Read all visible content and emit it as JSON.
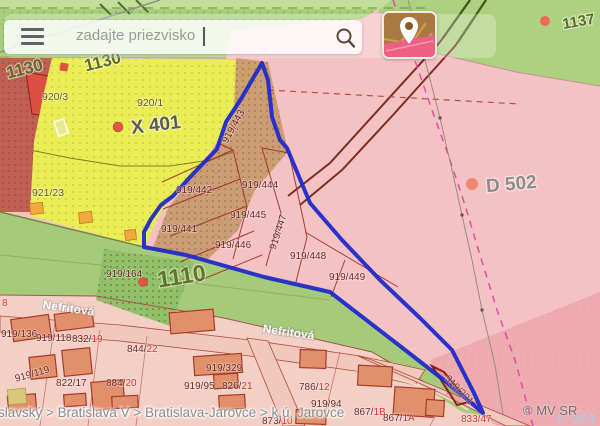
{
  "search": {
    "placeholder": "zadajte priezvisko"
  },
  "breadcrumb": {
    "text": "islavský > Bratislava V > Bratislava-Jarovce > k.ú. Jarovce"
  },
  "attribution": {
    "mvsr": "© MV SR",
    "partial": "© 201"
  },
  "zone_labels": [
    {
      "text": "1130"
    },
    {
      "text": "1130"
    },
    {
      "text": "1137"
    },
    {
      "text": "X 401"
    },
    {
      "text": "D 502"
    },
    {
      "text": "1110"
    },
    {
      "text": "920/1"
    },
    {
      "text": "920/3"
    },
    {
      "text": "921/23"
    }
  ],
  "parcel_labels": [
    {
      "text": "919/443"
    },
    {
      "text": "919/442"
    },
    {
      "text": "919/444"
    },
    {
      "text": "919/445"
    },
    {
      "text": "919/441"
    },
    {
      "text": "919/446"
    },
    {
      "text": "919/447"
    },
    {
      "text": "919/448"
    },
    {
      "text": "919/449"
    },
    {
      "text": "919/164"
    },
    {
      "text": "919/201"
    }
  ],
  "address_labels": [
    {
      "text": "",
      "red": "8"
    },
    {
      "text": "919/136",
      "red": ""
    },
    {
      "text": "919/118",
      "red": ""
    },
    {
      "text": "832/",
      "red": "19"
    },
    {
      "text": "844/",
      "red": "22"
    },
    {
      "text": "919/119",
      "red": ""
    },
    {
      "text": "822/17",
      "red": ""
    },
    {
      "text": "884/",
      "red": "20"
    },
    {
      "text": "919/329",
      "red": ""
    },
    {
      "text": "919/95",
      "red": ""
    },
    {
      "text": "826/",
      "red": "21"
    },
    {
      "text": "786/",
      "red": "12"
    },
    {
      "text": "919/94",
      "red": ""
    },
    {
      "text": "867/",
      "red": "1B"
    },
    {
      "text": "867/",
      "red": "1A"
    },
    {
      "text": "873/",
      "red": "10"
    },
    {
      "text": "",
      "red": "833/47"
    }
  ],
  "street_labels": [
    {
      "text": "Nefritová"
    },
    {
      "text": "Nefritová"
    }
  ],
  "colors": {
    "selection_blue": "#1d2bc9",
    "zone_green": "#a9cf7d",
    "zone_yellow": "#ebed56",
    "zone_pink": "#f5c2c4",
    "zone_tan": "#c8996e",
    "house_orange": "#e2906b",
    "parcel_line": "#9b2d24",
    "label_red": "#d2342b"
  }
}
